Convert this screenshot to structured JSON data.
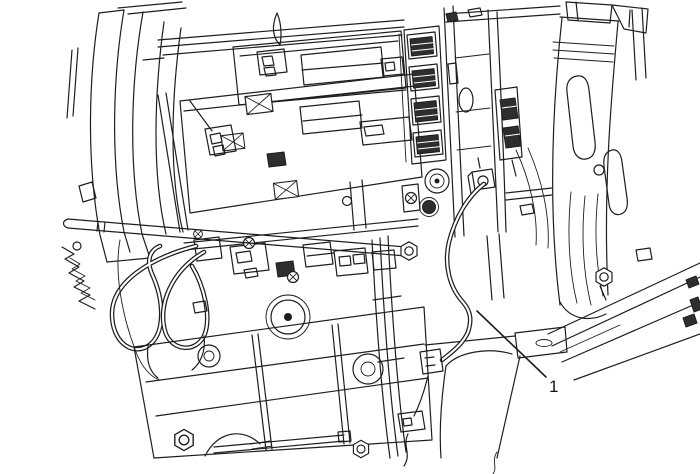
{
  "page": {
    "background_color": "#ffffff"
  },
  "figure": {
    "kind": "technical-line-illustration",
    "subject": "Vehicle instrument panel and center console substructure with wiring harness",
    "ink_color": "#1e1e1e",
    "canvas": {
      "width": 700,
      "height": 474
    },
    "callouts": [
      {
        "label": "1",
        "target": "wiring-harness",
        "label_x": 549,
        "label_y": 392,
        "leader": {
          "x1": 477,
          "y1": 311,
          "x2": 546,
          "y2": 377
        }
      }
    ]
  }
}
